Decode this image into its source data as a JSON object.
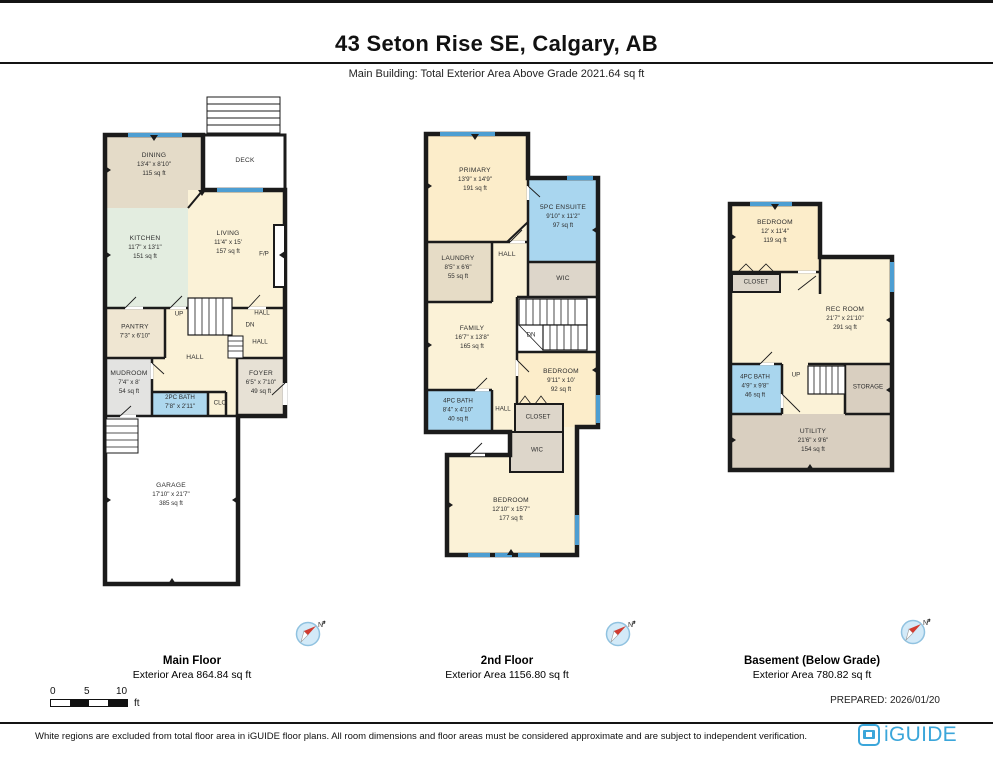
{
  "header": {
    "title": "43 Seton Rise SE, Calgary, AB",
    "subtitle": "Main Building: Total Exterior Area Above Grade 2021.64 sq ft"
  },
  "compass": {
    "n": "N"
  },
  "scale": {
    "n0": "0",
    "n5": "5",
    "n10": "10",
    "unit": "ft"
  },
  "footer": {
    "prepared": "PREPARED: 2026/01/20",
    "disclaimer": "White regions are excluded from total floor area in iGUIDE floor plans. All room dimensions and floor areas must be considered approximate and are subject to independent verification.",
    "brand": "iGUIDE"
  },
  "floors": {
    "main": {
      "label": "Main Floor",
      "area_label": "Exterior Area 864.84 sq ft",
      "rooms": {
        "dining": {
          "name": "DINING",
          "dims": "13'4\" x 8'10\"",
          "area": "115 sq ft"
        },
        "deck": {
          "name": "DECK"
        },
        "kitchen": {
          "name": "KITCHEN",
          "dims": "11'7\" x 13'1\"",
          "area": "151 sq ft"
        },
        "living": {
          "name": "LIVING",
          "dims": "11'4\" x 15'",
          "area": "157 sq ft"
        },
        "fp": {
          "name": "F/P"
        },
        "pantry": {
          "name": "PANTRY",
          "dims": "7'3\" x 6'10\""
        },
        "up": {
          "name": "UP"
        },
        "dn": {
          "name": "DN"
        },
        "hall": {
          "name": "HALL"
        },
        "hall_a": {
          "name": "HALL"
        },
        "hall_b": {
          "name": "HALL"
        },
        "mudroom": {
          "name": "MUDROOM",
          "dims": "7'4\" x 8'",
          "area": "54 sq ft"
        },
        "foyer": {
          "name": "FOYER",
          "dims": "6'5\" x 7'10\"",
          "area": "49 sq ft"
        },
        "bath": {
          "name": "2PC BATH",
          "dims": "7'8\" x 2'11\""
        },
        "clo": {
          "name": "CLO"
        },
        "garage": {
          "name": "GARAGE",
          "dims": "17'10\" x 21'7\"",
          "area": "385 sq ft"
        }
      }
    },
    "second": {
      "label": "2nd Floor",
      "area_label": "Exterior Area 1156.80 sq ft",
      "rooms": {
        "primary": {
          "name": "PRIMARY",
          "dims": "13'9\" x 14'9\"",
          "area": "191 sq ft"
        },
        "ensuite": {
          "name": "5PC ENSUITE",
          "dims": "9'10\" x 11'2\"",
          "area": "97 sq ft"
        },
        "laundry": {
          "name": "LAUNDRY",
          "dims": "8'5\" x 6'6\"",
          "area": "55 sq ft"
        },
        "hall": {
          "name": "HALL"
        },
        "wic": {
          "name": "WIC"
        },
        "dn": {
          "name": "DN"
        },
        "family": {
          "name": "FAMILY",
          "dims": "16'7\" x 13'8\"",
          "area": "165 sq ft"
        },
        "bedroom_b": {
          "name": "BEDROOM",
          "dims": "9'11\" x 10'",
          "area": "92 sq ft"
        },
        "bath": {
          "name": "4PC BATH",
          "dims": "8'4\" x 4'10\"",
          "area": "40 sq ft"
        },
        "hall_b": {
          "name": "HALL"
        },
        "closet": {
          "name": "CLOSET"
        },
        "wic_b": {
          "name": "WIC"
        },
        "bedroom_c": {
          "name": "BEDROOM",
          "dims": "12'10\" x 15'7\"",
          "area": "177 sq ft"
        }
      }
    },
    "basement": {
      "label": "Basement (Below Grade)",
      "area_label": "Exterior Area 780.82 sq ft",
      "rooms": {
        "bedroom": {
          "name": "BEDROOM",
          "dims": "12' x 11'4\"",
          "area": "119 sq ft"
        },
        "closet": {
          "name": "CLOSET"
        },
        "rec": {
          "name": "REC ROOM",
          "dims": "21'7\" x 21'10\"",
          "area": "291 sq ft"
        },
        "bath": {
          "name": "4PC BATH",
          "dims": "4'9\" x 9'8\"",
          "area": "46 sq ft"
        },
        "up": {
          "name": "UP"
        },
        "storage": {
          "name": "STORAGE"
        },
        "utility": {
          "name": "UTILITY",
          "dims": "21'6\" x 9'6\"",
          "area": "154 sq ft"
        }
      }
    }
  }
}
